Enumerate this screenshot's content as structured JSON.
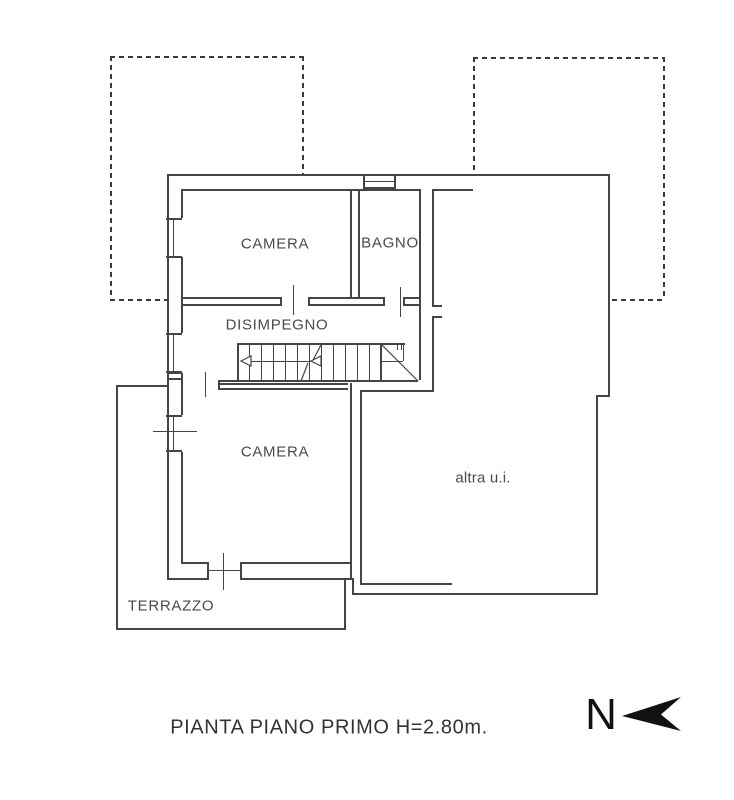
{
  "plan": {
    "rooms": {
      "camera1": "CAMERA",
      "bagno": "BAGNO",
      "disimpegno": "DISIMPEGNO",
      "camera2": "CAMERA",
      "terrazzo": "TERRAZZO",
      "altra_ui": "altra u.i."
    }
  },
  "title": "PIANTA PIANO PRIMO H=2.80m.",
  "north": "N",
  "colors": {
    "line": "#454545",
    "dashed_line": "#3a3a3a",
    "text": "#4a4a4a",
    "title_text": "#333333",
    "north_arrow": "#111111",
    "background": "#ffffff"
  }
}
